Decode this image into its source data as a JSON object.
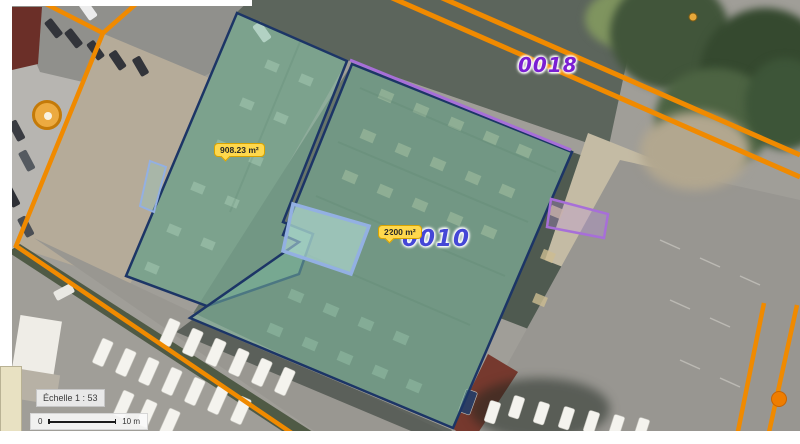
{
  "viewer": {
    "scale_label": "Échelle 1 : 53",
    "scalebar": {
      "zero": "0",
      "distance": "10 m"
    }
  },
  "parcels": [
    {
      "number": "0018"
    },
    {
      "number": "0010"
    }
  ],
  "measurements": [
    {
      "area": "908.23 m²"
    },
    {
      "area": "2200 m²"
    }
  ],
  "markers": [
    {
      "name": "orange-circle-marker"
    },
    {
      "name": "orange-vertex-dot"
    },
    {
      "name": "small-orange-dot"
    }
  ],
  "colors": {
    "boundary_orange": "#f08a00",
    "parcel_fill": "#7cba9e",
    "parcel_stroke": "#1c3566",
    "measurement_bg": "#ffd84d",
    "measurement_border": "#d9a300",
    "annotation_purple": "#a76fd8",
    "annotation_blue": "#93b0e2",
    "parcel_0018": "#7b1fd3",
    "parcel_0010": "#4547d6"
  }
}
